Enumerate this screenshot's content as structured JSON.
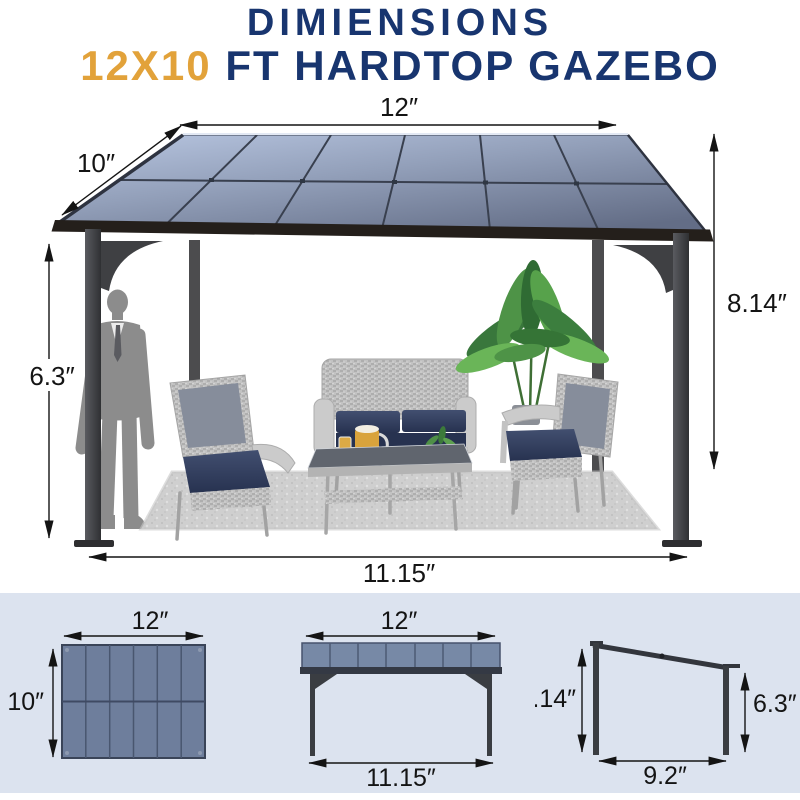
{
  "title": {
    "line1": "DIMIENSIONS",
    "line2_highlight": "12X10",
    "line2_rest": " FT HARDTOP GAZEBO"
  },
  "colors": {
    "title_navy": "#18356f",
    "title_orange": "#e2a23a",
    "roof_blue_light": "#b8c6e1",
    "roof_blue_dark": "#636d86",
    "panel_blue": "#6e7e9c",
    "cushion_navy": "#2c3854",
    "frame_dark": "#3a3a3e",
    "strip_background": "#dce3ef"
  },
  "main_diagram": {
    "roof_width": "12″",
    "roof_depth": "10″",
    "front_height": "6.3″",
    "total_height": "8.14″",
    "base_width": "11.15″"
  },
  "bottom_diagrams": {
    "top_view": {
      "width": "12″",
      "depth": "10″"
    },
    "front_view": {
      "roof_width": "12″",
      "base_width": "11.15″"
    },
    "side_view": {
      "total_height": "8.14″",
      "front_height": "6.3″",
      "base_depth": "9.2″"
    }
  }
}
